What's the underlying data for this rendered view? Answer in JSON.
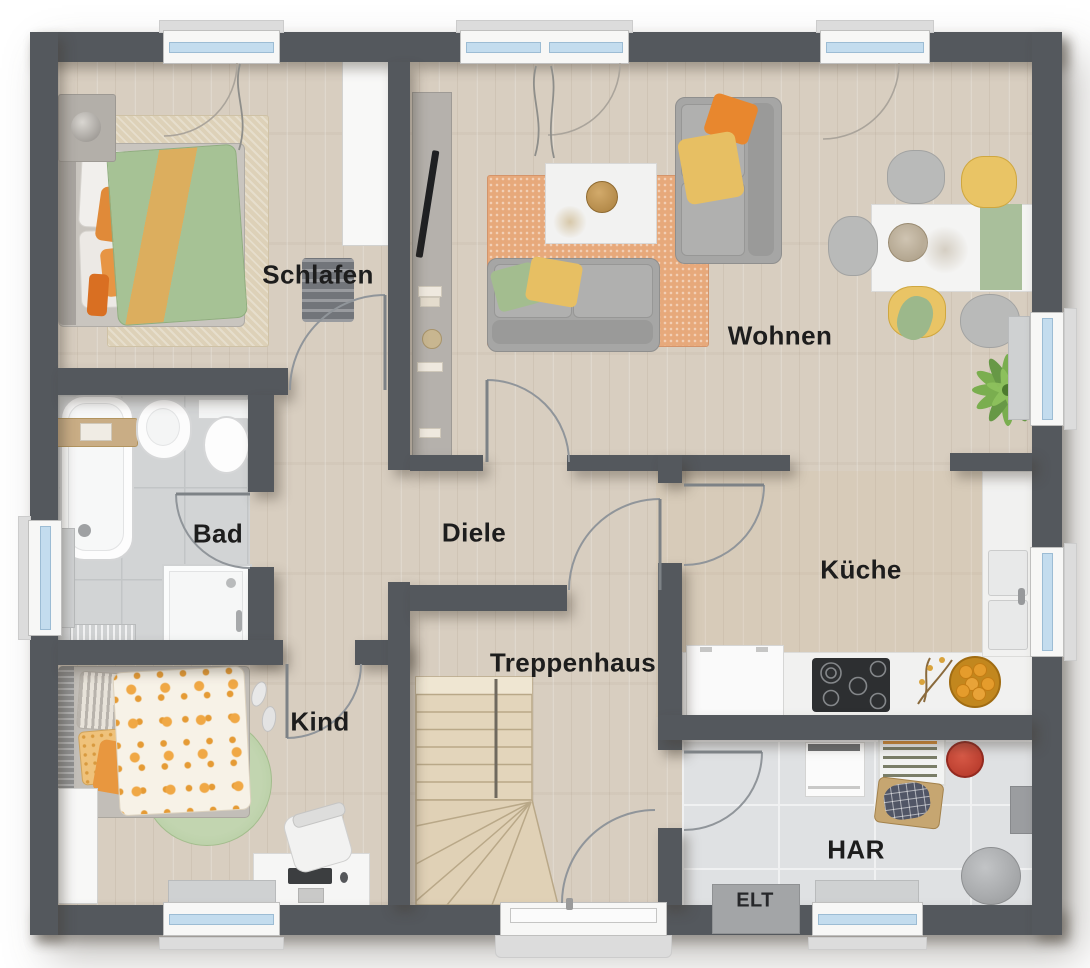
{
  "rooms": {
    "schlafen": {
      "label": "Schlafen",
      "furniture": [
        "double-bed",
        "bedside-rug",
        "nightstand-lamp",
        "slatted-bench",
        "wardrobe"
      ]
    },
    "wohnen": {
      "label": "Wohnen",
      "furniture": [
        "sofa",
        "lounge-sofa",
        "coffee-table",
        "orange-rug",
        "tv-sideboard",
        "dining-table",
        "dining-chairs",
        "potted-palm"
      ]
    },
    "bad": {
      "label": "Bad",
      "furniture": [
        "bathtub",
        "washbasin",
        "toilet",
        "shower",
        "radiator"
      ]
    },
    "diele": {
      "label": "Diele",
      "furniture": []
    },
    "kueche": {
      "label": "Küche",
      "furniture": [
        "kitchen-counter",
        "cooktop",
        "fridge",
        "double-sink",
        "fruit-bowl",
        "twig-decor"
      ]
    },
    "kind": {
      "label": "Kind",
      "furniture": [
        "single-bed",
        "round-rug",
        "desk",
        "desk-chair",
        "wardrobe",
        "slippers"
      ]
    },
    "treppenhaus": {
      "label": "Treppenhaus",
      "furniture": [
        "winder-staircase",
        "entrance-door"
      ]
    },
    "har": {
      "label": "HAR",
      "furniture": [
        "washing-machine",
        "drying-rack",
        "laundry-basket",
        "red-bucket",
        "pouf"
      ]
    },
    "elt": {
      "label": "ELT"
    }
  },
  "colors": {
    "wall": "#54585d",
    "wood_floor": "#d8cec0",
    "bad_tile": "#d2d4d5",
    "har_tile": "#dfe1e3",
    "window_glass": "#c3dcee",
    "accent_orange": "#e8872e",
    "accent_yellow": "#e7bf63",
    "accent_green": "#a6c295",
    "rug_orange": "#e7a97b",
    "rug_green": "#b7cda4"
  }
}
